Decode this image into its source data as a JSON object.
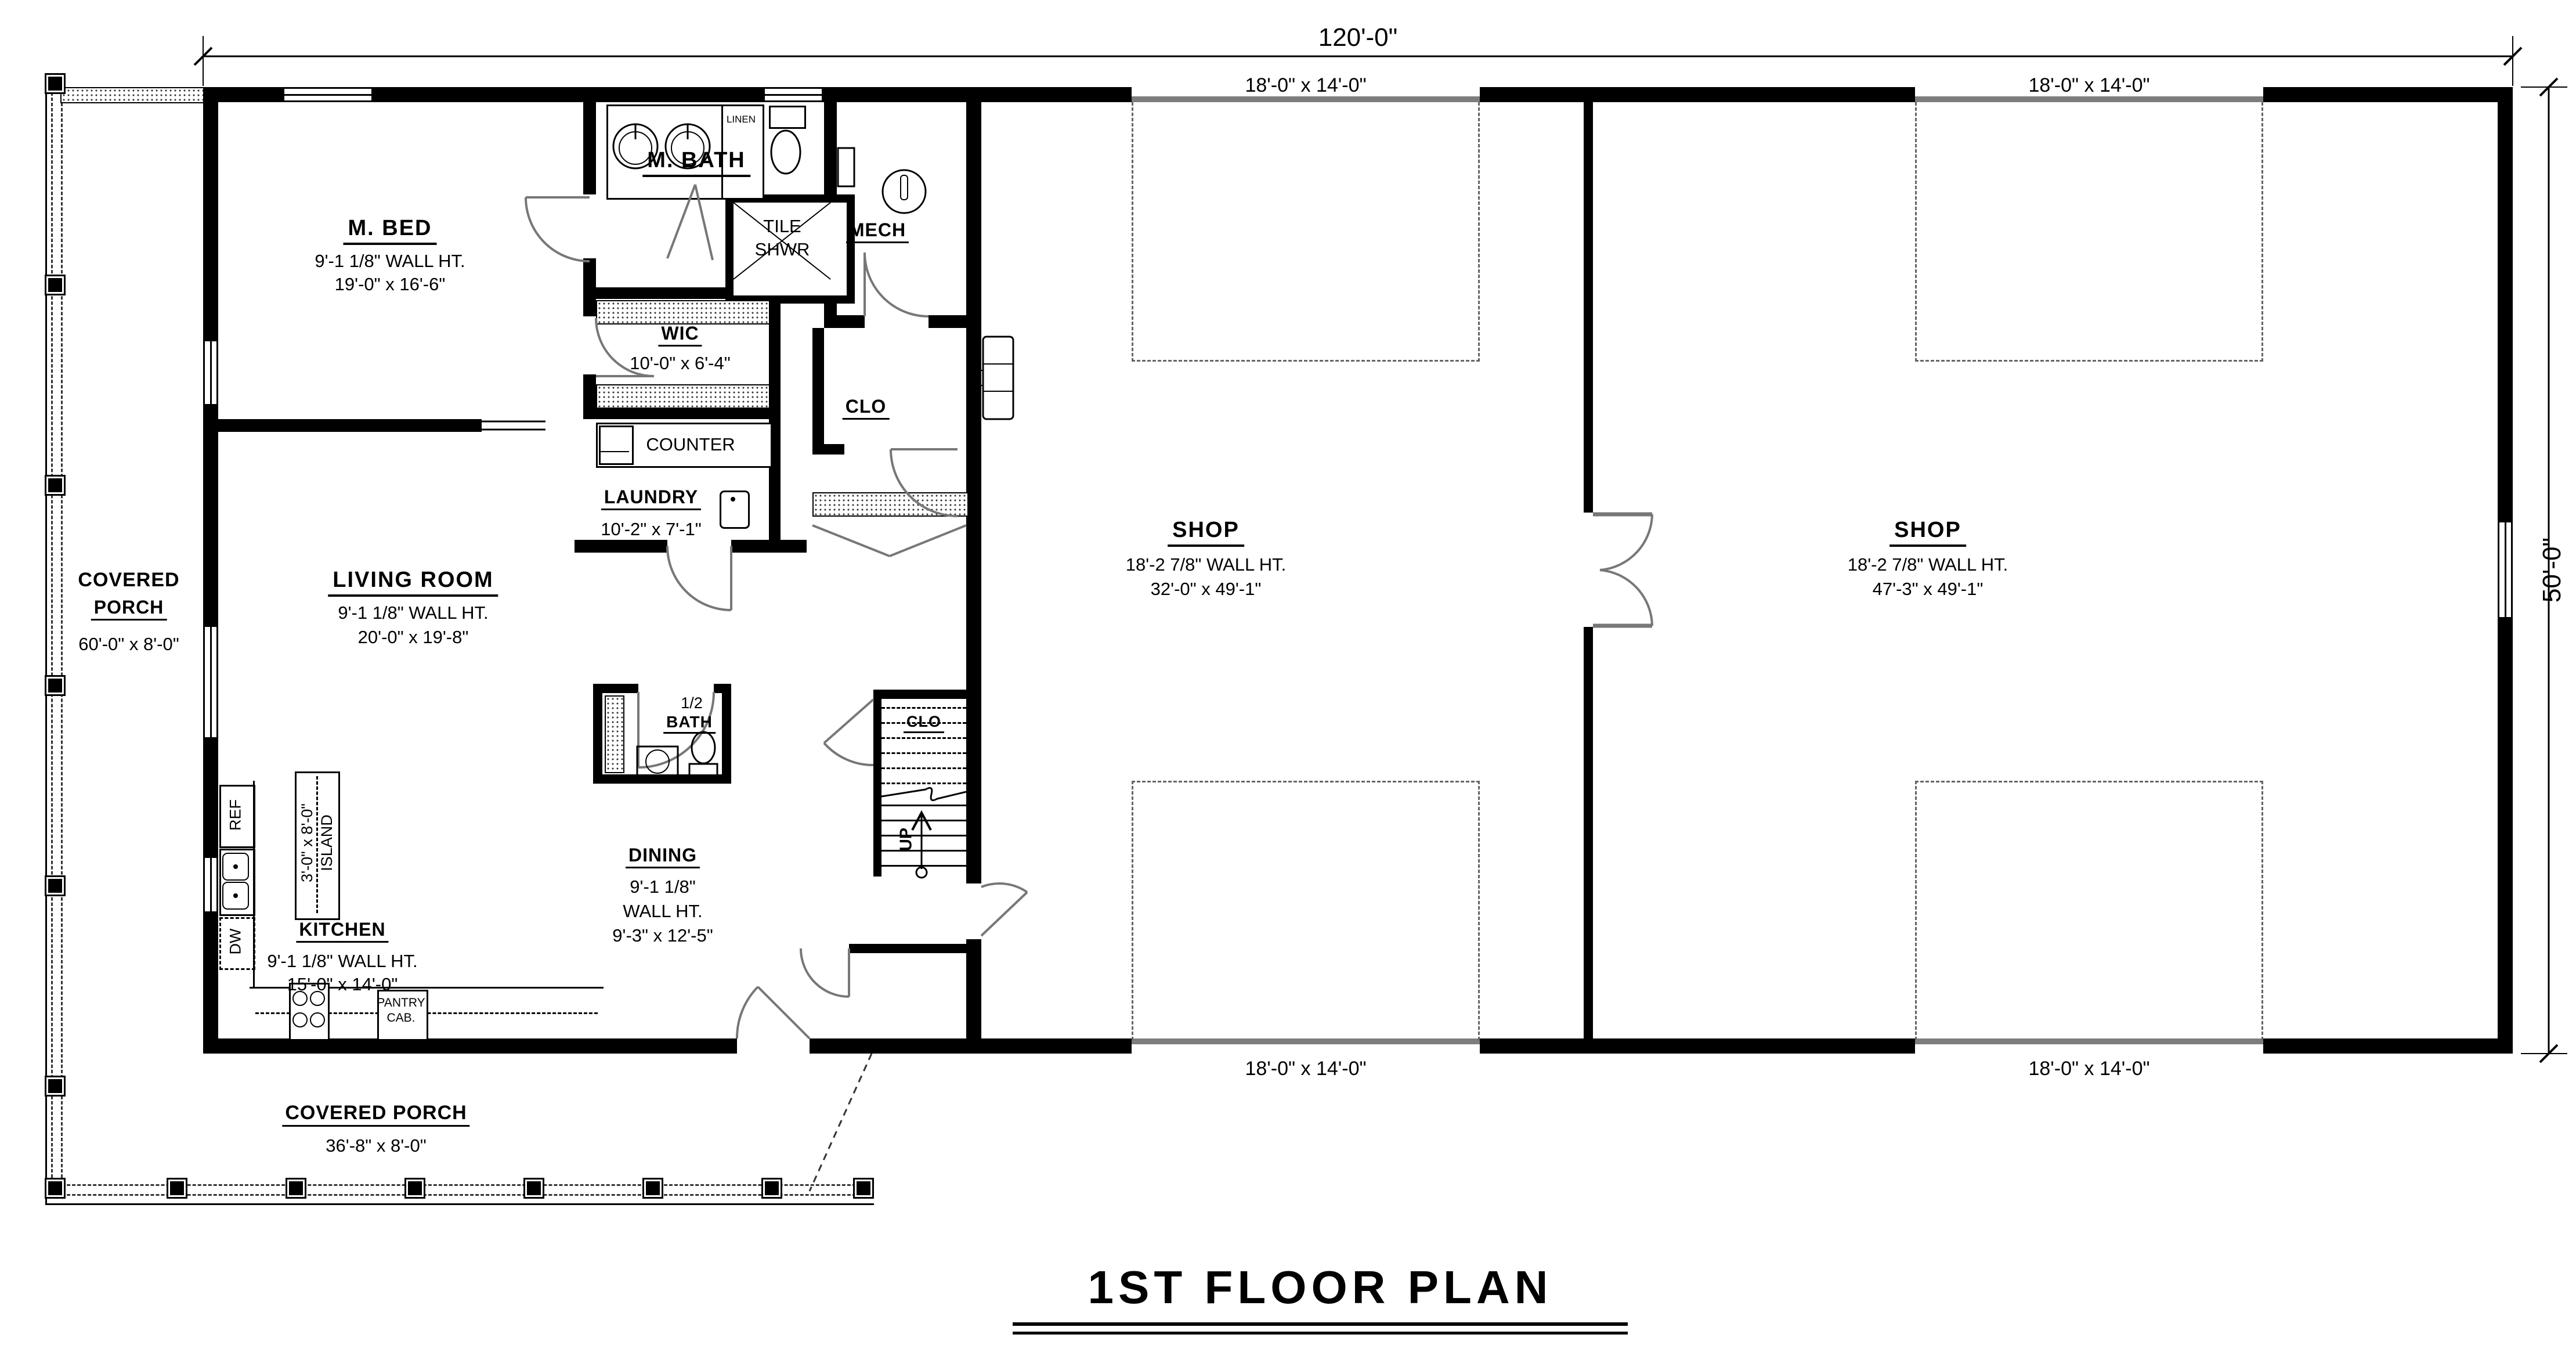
{
  "plan": {
    "title": "1ST FLOOR PLAN",
    "dim_width": "120'-0\"",
    "dim_depth": "50'-0\""
  },
  "rooms": {
    "m_bed": {
      "name": "M. BED",
      "wall_ht": "9'-1 1/8\" WALL HT.",
      "size": "19'-0\" x 16'-6\""
    },
    "m_bath": {
      "name": "M. BATH"
    },
    "tile_shwr": {
      "line1": "TILE",
      "line2": "SHWR"
    },
    "mech": {
      "name": "MECH"
    },
    "wic": {
      "name": "WIC",
      "size": "10'-0\" x 6'-4\""
    },
    "clo_hall": {
      "name": "CLO"
    },
    "laundry": {
      "name": "LAUNDRY",
      "size": "10'-2\" x 7'-1\"",
      "counter": "COUNTER"
    },
    "living": {
      "name": "LIVING ROOM",
      "wall_ht": "9'-1 1/8\" WALL HT.",
      "size": "20'-0\" x 19'-8\""
    },
    "kitchen": {
      "name": "KITCHEN",
      "wall_ht": "9'-1 1/8\" WALL HT.",
      "size": "15'-0\" x 14'-0\""
    },
    "island": {
      "size": "3'-0\" x 8'-0\"",
      "name": "ISLAND"
    },
    "dining": {
      "name": "DINING",
      "ht1": "9'-1 1/8\"",
      "ht2": "WALL HT.",
      "size": "9'-3\" x 12'-5\""
    },
    "half_bath": {
      "line1": "1/2",
      "line2": "BATH"
    },
    "clo_stairs": {
      "name": "CLO"
    },
    "stairs": {
      "up": "UP"
    },
    "shop_left": {
      "name": "SHOP",
      "wall_ht": "18'-2 7/8\" WALL HT.",
      "size": "32'-0\" x 49'-1\""
    },
    "shop_right": {
      "name": "SHOP",
      "wall_ht": "18'-2 7/8\" WALL HT.",
      "size": "47'-3\" x 49'-1\""
    },
    "porch_left": {
      "name1": "COVERED",
      "name2": "PORCH",
      "size": "60'-0\" x 8'-0\""
    },
    "porch_bottom": {
      "name": "COVERED PORCH",
      "size": "36'-8\" x 8'-0\""
    }
  },
  "fixtures": {
    "ref": "REF",
    "dw": "DW",
    "linen": "LINEN",
    "pantry1": "PANTRY",
    "pantry2": "CAB."
  },
  "garage": {
    "top_left": "18'-0\" x 14'-0\"",
    "top_right": "18'-0\" x 14'-0\"",
    "bottom_left": "18'-0\" x 14'-0\"",
    "bottom_right": "18'-0\" x 14'-0\""
  }
}
